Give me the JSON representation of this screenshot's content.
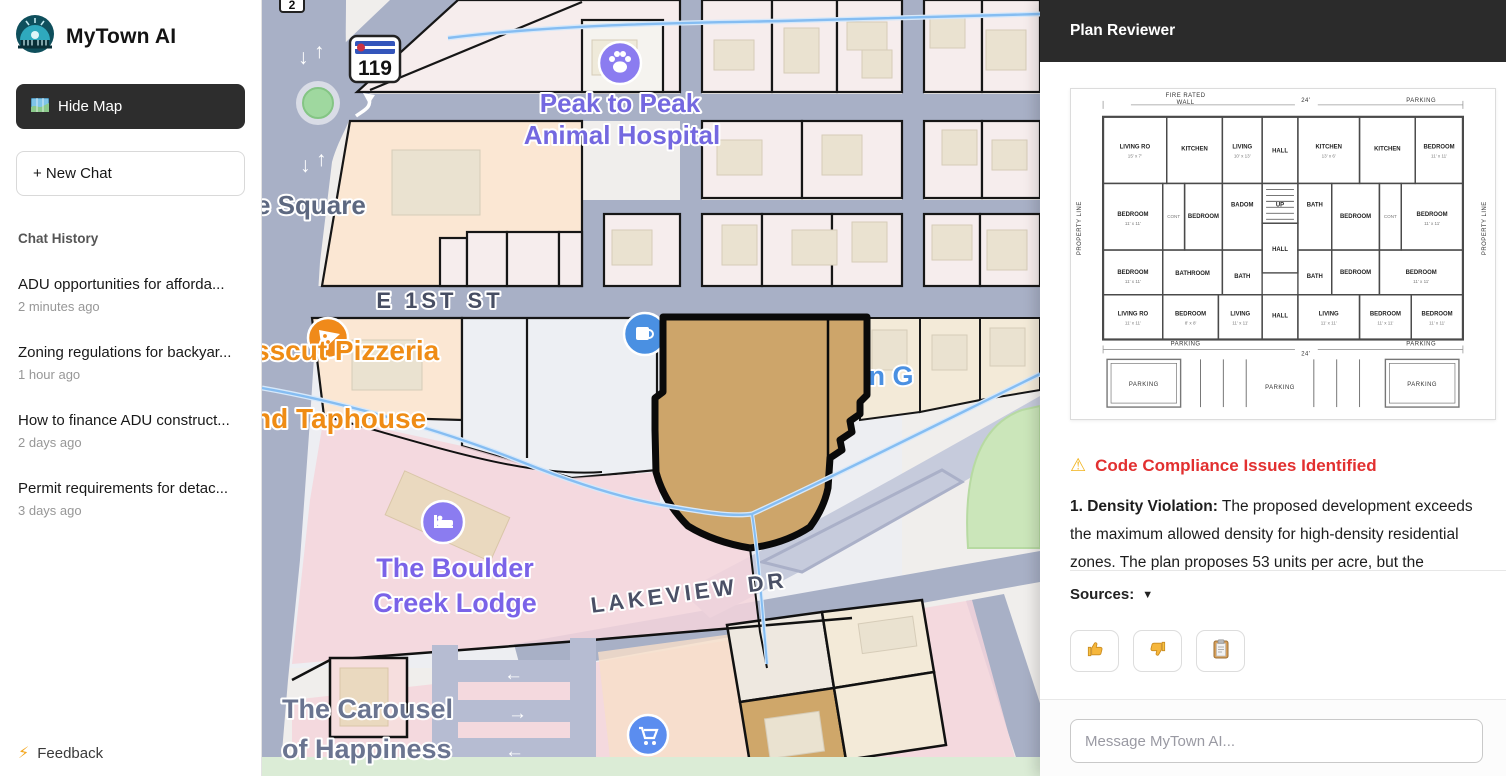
{
  "sidebar": {
    "brand": "MyTown AI",
    "hide_map_label": "Hide Map",
    "new_chat_label": "+ New Chat",
    "history_title": "Chat History",
    "history": [
      {
        "title": "ADU opportunities for afforda...",
        "time": "2 minutes ago"
      },
      {
        "title": "Zoning regulations for backyar...",
        "time": "1 hour ago"
      },
      {
        "title": "How to finance ADU construct...",
        "time": "2 days ago"
      },
      {
        "title": "Permit requirements for detac...",
        "time": "3 days ago"
      }
    ],
    "feedback_icon": "⚡",
    "feedback_label": "Feedback"
  },
  "map": {
    "route_shield": "119",
    "partial_shield": "2",
    "labels": {
      "square": "e Square",
      "e_1st_st": "E 1ST ST",
      "peak1": "Peak to Peak",
      "peak2": "Animal Hospital",
      "pizzeria1": "sscut Pizzeria",
      "pizzeria2": "nd Taphouse",
      "mountain": "Mountain G",
      "lodge1": "The Boulder",
      "lodge2": "Creek Lodge",
      "lakeview": "LAKEVIEW DR",
      "carousel1": "The Carousel",
      "carousel2": "of Happiness"
    },
    "arrows": {
      "down": "↓",
      "up": "↑",
      "left": "←",
      "right": "→"
    },
    "colors": {
      "road": "#a8b0c6",
      "highlighted_parcel": "#cda56a",
      "pink_zone": "#f4d5dc",
      "park_green": "#cbe6ba",
      "purple_label": "#7a63e8",
      "orange_label": "#ef8c15",
      "blue_label": "#4a90e2"
    }
  },
  "plan_reviewer": {
    "title": "Plan Reviewer",
    "floorplan": {
      "dims": {
        "fire_rated_1": "FIRE RATED",
        "fire_rated_2": "WALL",
        "top_center": "24'",
        "top_right": "PARKING",
        "bottom_left": "PARKING",
        "bottom_center": "24'",
        "bottom_right": "PARKING",
        "property_left": "PROPERTY LINE",
        "property_right": "PROPERTY LINE",
        "stall_left": "PARKING",
        "stall_center": "PARKING",
        "stall_right": "PARKING"
      },
      "rooms": [
        {
          "l": "LIVING RO",
          "s": "15' x 7'"
        },
        {
          "l": "KITCHEN",
          "s": ""
        },
        {
          "l": "LIVING",
          "s": "10' x 13'"
        },
        {
          "l": "HALL",
          "s": ""
        },
        {
          "l": "KITCHEN",
          "s": "13' x 6'"
        },
        {
          "l": "KITCHEN",
          "s": ""
        },
        {
          "l": "BEDROOM",
          "s": "11' x 11'"
        },
        {
          "l": "BEDROOM",
          "s": "11' x 11'"
        },
        {
          "l": "CONT",
          "s": ""
        },
        {
          "l": "BEDROOM",
          "s": ""
        },
        {
          "l": "BADOM",
          "s": ""
        },
        {
          "l": "UP",
          "s": ""
        },
        {
          "l": "BATH",
          "s": ""
        },
        {
          "l": "BEDROOM",
          "s": ""
        },
        {
          "l": "CONT",
          "s": ""
        },
        {
          "l": "BEDROOM",
          "s": "11' x 11'"
        },
        {
          "l": "BEDROOM",
          "s": "11' x 11'"
        },
        {
          "l": "BATHROOM",
          "s": ""
        },
        {
          "l": "BATH",
          "s": ""
        },
        {
          "l": "HALL",
          "s": ""
        },
        {
          "l": "BATH",
          "s": ""
        },
        {
          "l": "BEDROOM",
          "s": ""
        },
        {
          "l": "BEDROOM",
          "s": "11' x 11'"
        },
        {
          "l": "LIVING RO",
          "s": "11' x 11'"
        },
        {
          "l": "BEDROOM",
          "s": "8' x 8'"
        },
        {
          "l": "LIVING",
          "s": "11' x 11'"
        },
        {
          "l": "HALL",
          "s": ""
        },
        {
          "l": "LIVING",
          "s": "11' x 11'"
        },
        {
          "l": "BEDROOM",
          "s": "11' x 11'"
        },
        {
          "l": "BEDROOM",
          "s": "11' x 11'"
        }
      ]
    },
    "warning_icon": "⚠",
    "issues_heading": "Code Compliance Issues Identified",
    "issue_bold": "1. Density Violation:",
    "issue_text": " The proposed development exceeds the maximum allowed density for high-density residential zones. The plan proposes 53 units per acre, but the",
    "sources_label": "Sources:",
    "sources_caret": "▼",
    "composer_placeholder": "Message MyTown AI..."
  }
}
